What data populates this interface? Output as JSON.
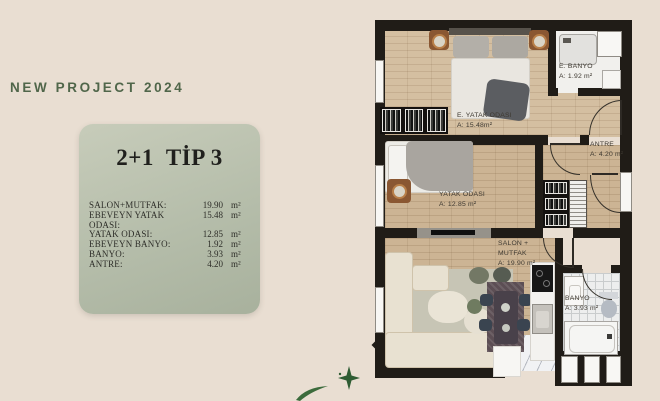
{
  "header": {
    "title": "NEW PROJECT 2024"
  },
  "card": {
    "title": "2+1  TİP 3",
    "rows": [
      {
        "label": "SALON+MUTFAK:",
        "value": "19.90",
        "unit": "m²"
      },
      {
        "label": "EBEVEYN YATAK ODASI:",
        "value": "15.48",
        "unit": "m²"
      },
      {
        "label": "YATAK ODASI:",
        "value": "12.85",
        "unit": "m²"
      },
      {
        "label": "EBEVEYN BANYO:",
        "value": "1.92",
        "unit": "m²"
      },
      {
        "label": "BANYO:",
        "value": "3.93",
        "unit": "m²"
      },
      {
        "label": "ANTRE:",
        "value": "4.20",
        "unit": "m²"
      }
    ]
  },
  "floorplan": {
    "rooms": {
      "master_bedroom": {
        "name": "E. YATAK ODASI",
        "area": "A: 15.48m²"
      },
      "master_bathroom": {
        "name": "E. BANYO",
        "area": "A: 1.92 m²"
      },
      "bedroom": {
        "name": "YATAK ODASI",
        "area": "A: 12.85 m²"
      },
      "hallway": {
        "name": "ANTRE",
        "area": "A: 4.20 m²"
      },
      "living_kitchen": {
        "name_line1": "SALON +",
        "name_line2": "MUTFAK",
        "area": "A: 19.90 m²"
      },
      "bathroom": {
        "name": "BANYO",
        "area": "A: 3.93 m²"
      }
    }
  },
  "colors": {
    "background": "#e9ded2",
    "heading_green": "#50664a",
    "card_sage": "#b7bfab",
    "wall": "#201c17",
    "wood_floor": "#cfb999",
    "accent_leaf": "#3c6b3c"
  }
}
